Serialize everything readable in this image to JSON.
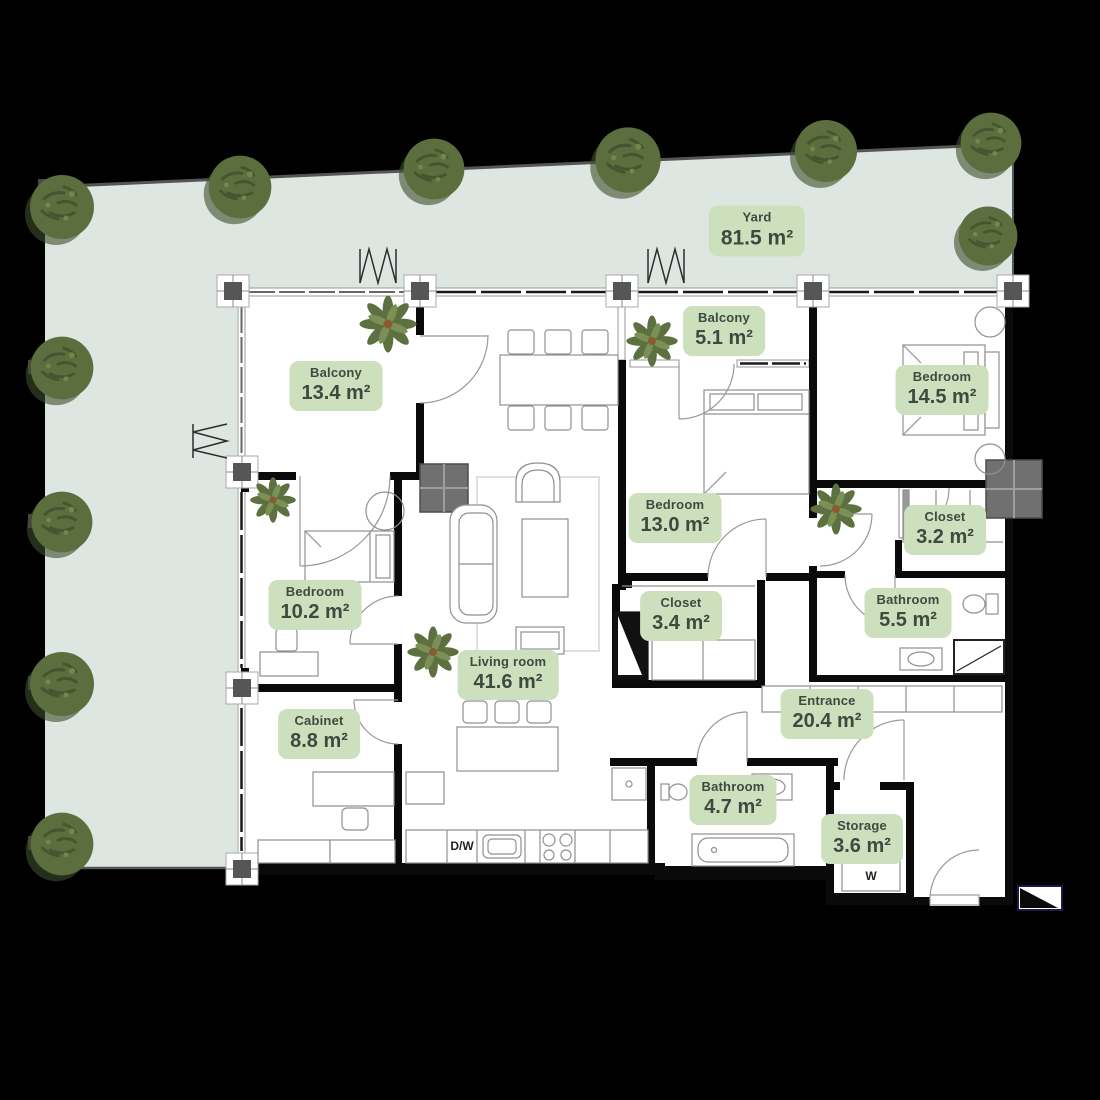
{
  "colors": {
    "background": "#000000",
    "yard_fill": "#dee6e1",
    "label_bg": "#cde0bd",
    "label_text": "#3d4a40",
    "tree_green": "#5c6e3e",
    "wall": "#0a0a0a",
    "furniture_line": "#909090"
  },
  "yard": {
    "name": "Yard",
    "area": "81.5 m²"
  },
  "rooms": [
    {
      "key": "balcony-large",
      "name": "Balcony",
      "area": "13.4 m²"
    },
    {
      "key": "balcony-small",
      "name": "Balcony",
      "area": "5.1 m²"
    },
    {
      "key": "bedroom-top-right",
      "name": "Bedroom",
      "area": "14.5 m²"
    },
    {
      "key": "bedroom-middle",
      "name": "Bedroom",
      "area": "13.0 m²"
    },
    {
      "key": "closet-small",
      "name": "Closet",
      "area": "3.2 m²"
    },
    {
      "key": "bedroom-left",
      "name": "Bedroom",
      "area": "10.2 m²"
    },
    {
      "key": "closet-large",
      "name": "Closet",
      "area": "3.4 m²"
    },
    {
      "key": "bathroom-large",
      "name": "Bathroom",
      "area": "5.5 m²"
    },
    {
      "key": "living-room",
      "name": "Living room",
      "area": "41.6 m²"
    },
    {
      "key": "cabinet",
      "name": "Cabinet",
      "area": "8.8 m²"
    },
    {
      "key": "entrance",
      "name": "Entrance",
      "area": "20.4 m²"
    },
    {
      "key": "bathroom-small",
      "name": "Bathroom",
      "area": "4.7 m²"
    },
    {
      "key": "storage",
      "name": "Storage",
      "area": "3.6 m²"
    }
  ],
  "appliances": {
    "dishwasher": "D/W",
    "washer": "W"
  }
}
